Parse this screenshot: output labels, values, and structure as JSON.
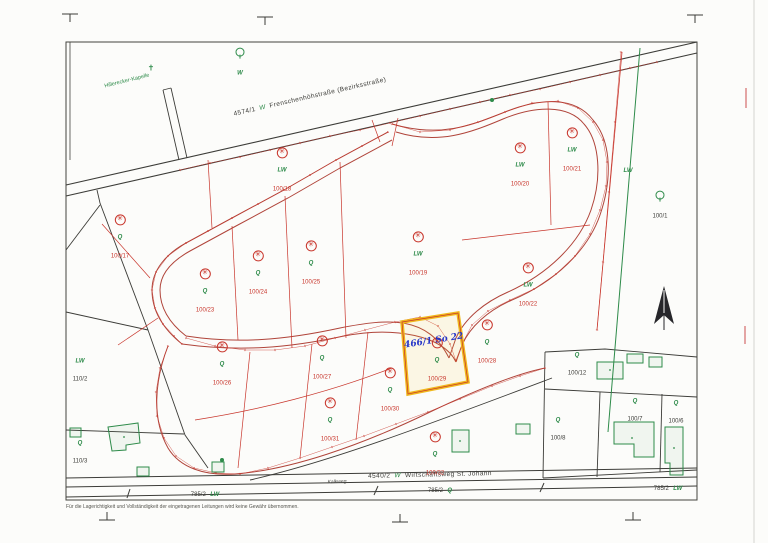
{
  "map": {
    "streets": {
      "top": {
        "number": "4574/1",
        "letter": "W",
        "name": "Frenschenhöhstraße (Bezirksstraße)"
      },
      "bottom": {
        "number": "4540/2",
        "letter": "W",
        "name": "Wirtschaftsweg St. Johann"
      },
      "path_label": "Kalkweg"
    },
    "landmark": "Hillerecker-Kapelle",
    "chapel_symbol": "✝",
    "annotation": {
      "text": "466/1 So 22",
      "color": "#2636c8"
    },
    "disclaimer": "Für die Lagerichtigkeit und Vollständigkeit der eingetragenen Leitungen wird keine Gewähr übernommen.",
    "symbols": {
      "fruit_tree": "✳",
      "use_orchard": "Q",
      "use_agriculture": "LW",
      "use_wood": "W"
    },
    "colors": {
      "boundary_red": "#c8352b",
      "road_red": "#b0443a",
      "vegetation_green": "#2e8b4a",
      "highlight_yellow": "#f0b81c",
      "annotation_blue": "#2636c8",
      "line_black": "#3c3c38"
    },
    "highlighted_parcel": "100/29",
    "red_parcels": [
      {
        "num": "100/17",
        "use": "Q",
        "x": 120,
        "y": 235
      },
      {
        "num": "100/18",
        "use": "LW",
        "x": 282,
        "y": 168
      },
      {
        "num": "100/19",
        "use": "LW",
        "x": 418,
        "y": 252
      },
      {
        "num": "100/20",
        "use": "LW",
        "x": 520,
        "y": 163
      },
      {
        "num": "100/21",
        "use": "LW",
        "x": 572,
        "y": 148
      },
      {
        "num": "100/22",
        "use": "LW",
        "x": 528,
        "y": 283
      },
      {
        "num": "100/23",
        "use": "Q",
        "x": 205,
        "y": 289
      },
      {
        "num": "100/24",
        "use": "Q",
        "x": 258,
        "y": 271
      },
      {
        "num": "100/25",
        "use": "Q",
        "x": 311,
        "y": 261
      },
      {
        "num": "100/26",
        "use": "Q",
        "x": 222,
        "y": 362
      },
      {
        "num": "100/27",
        "use": "Q",
        "x": 322,
        "y": 356
      },
      {
        "num": "100/28",
        "use": "Q",
        "x": 487,
        "y": 340
      },
      {
        "num": "100/29",
        "use": "Q",
        "x": 437,
        "y": 358,
        "highlight": true
      },
      {
        "num": "100/30",
        "use": "Q",
        "x": 390,
        "y": 388
      },
      {
        "num": "100/31",
        "use": "Q",
        "x": 330,
        "y": 418
      },
      {
        "num": "100/32",
        "use": "Q",
        "x": 435,
        "y": 452
      }
    ],
    "green_parcels": [
      {
        "x": 240,
        "y": 62,
        "tree": true,
        "use": "W"
      },
      {
        "x": 80,
        "y": 368,
        "use": "LW",
        "num": "110/2"
      },
      {
        "x": 80,
        "y": 450,
        "use": "Q",
        "num": "110/3"
      },
      {
        "x": 660,
        "y": 205,
        "tree": true,
        "num": "100/1"
      },
      {
        "x": 628,
        "y": 168,
        "use": "LW"
      },
      {
        "x": 577,
        "y": 362,
        "use": "Q",
        "num": "100/12"
      },
      {
        "x": 558,
        "y": 427,
        "use": "Q",
        "num": "100/8"
      },
      {
        "x": 635,
        "y": 408,
        "use": "Q",
        "num": "100/7"
      },
      {
        "x": 676,
        "y": 410,
        "use": "Q",
        "num": "100/6"
      }
    ],
    "strip_parcels": [
      {
        "x": 205,
        "y": 492,
        "num": "785/2",
        "use": "LW"
      },
      {
        "x": 440,
        "y": 488,
        "num": "785/2",
        "use": "Q"
      },
      {
        "x": 668,
        "y": 486,
        "num": "785/2",
        "use": "LW"
      }
    ]
  }
}
